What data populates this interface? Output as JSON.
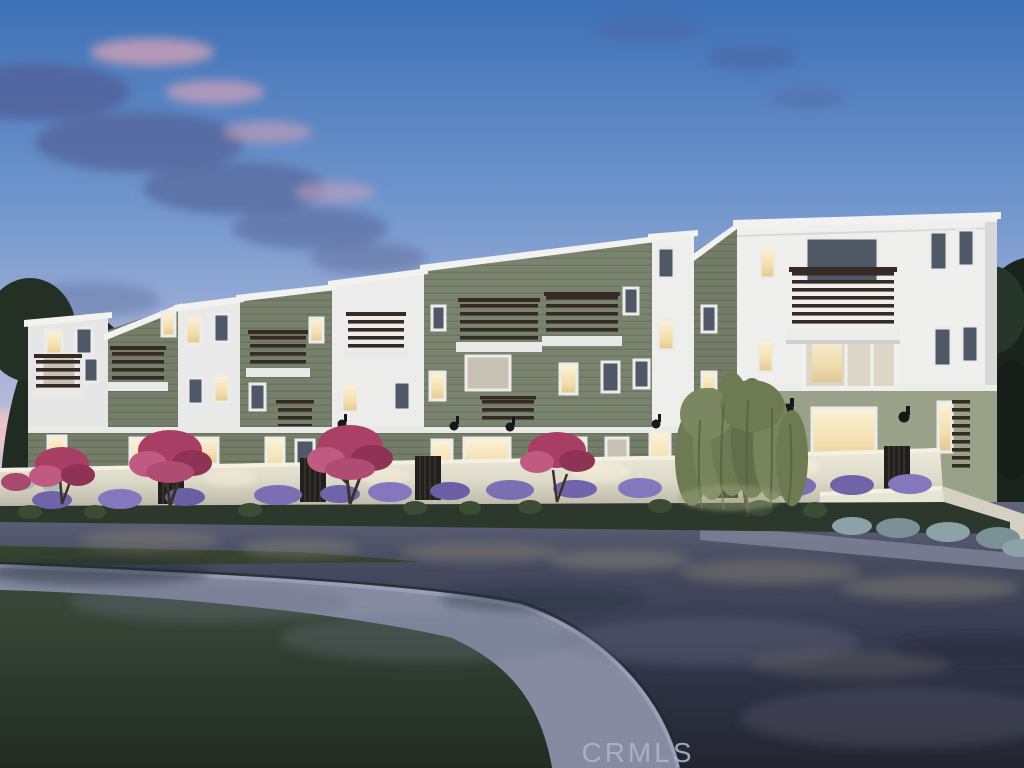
{
  "image": {
    "kind": "real-estate-listing-rendering",
    "scene": "Dusk architectural rendering of a row of modern three-story townhomes with alternating white and sage-green facades, dark wood-slat balcony railings, warmly lit windows, low white garden walls with lavender and pink crape-myrtle landscaping, a willow tree, and a curved street with sidewalk and lawn in the foreground",
    "time_of_day": "dusk"
  },
  "watermark": {
    "text": "CRMLS",
    "color": "#aeb3c8"
  },
  "palette": {
    "sky_top": "#3d70b6",
    "sky_mid": "#8aa6d4",
    "sky_horizon": "#e7cad1",
    "cloud_slate": "#54659a",
    "cloud_pink": "#d4a4b8",
    "facade_white": "#ececeb",
    "facade_green": "#76806b",
    "stucco_green_light": "#9aa189",
    "trim_white": "#f0f0ee",
    "railing_dark": "#352b24",
    "window_lit": "#f6e5bb",
    "window_dark": "#4e5866",
    "garden_wall": "#e2dfcf",
    "lavender": "#7268ad",
    "crape_myrtle": "#b04268",
    "tree_dark": "#1d271e",
    "willow": "#727e57",
    "street": "#363a4a",
    "sidewalk": "#8d92a8",
    "lawn": "#2f3b2e"
  }
}
